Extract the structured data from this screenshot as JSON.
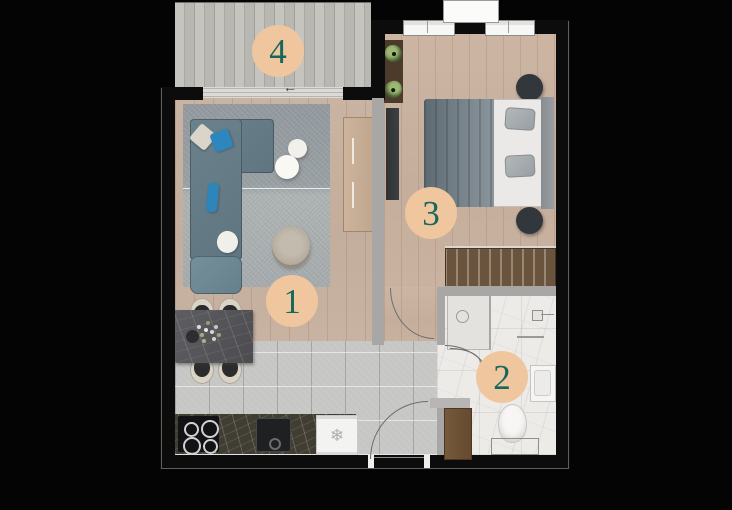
{
  "plan": {
    "badges": [
      "1",
      "2",
      "3",
      "4"
    ],
    "icons": {
      "fridge_snowflake": "❄",
      "balcony_door_arrow": "←"
    },
    "colors": {
      "badge_background": "#f0c69f",
      "badge_number": "#15685c",
      "background": "#040404",
      "sofa": "#647d88",
      "accent_pillow_blue": "#2b87bd",
      "living_wood": "#c6b0a0",
      "kitchen_tile": "#c6c6c5",
      "bathroom_marble": "#edebe8",
      "counter_marble": "#403e33",
      "wardrobe_wood": "#6b543e"
    }
  }
}
